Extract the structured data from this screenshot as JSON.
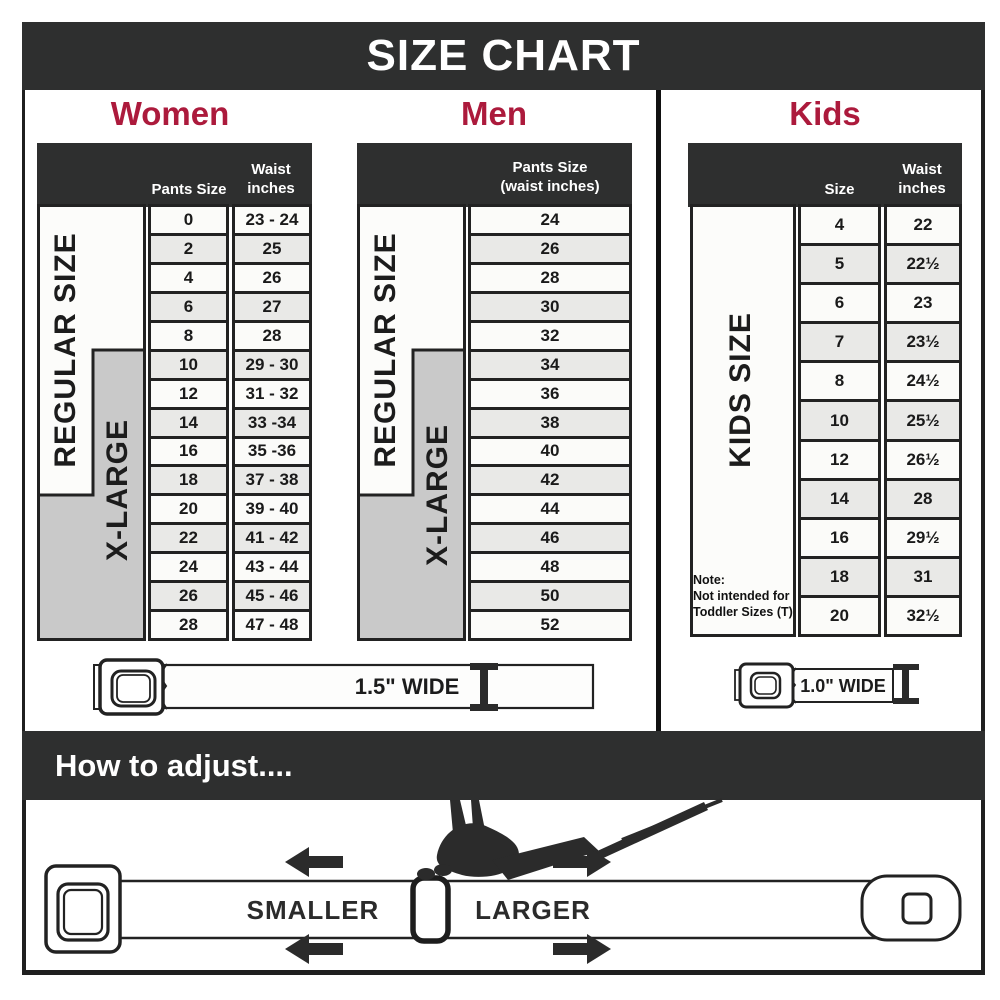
{
  "title": "SIZE CHART",
  "colors": {
    "accent": "#ac1a3c",
    "dark": "#2e2f2f",
    "band_gray": "#c9c9c9"
  },
  "sections": {
    "women": {
      "heading": "Women",
      "col1_header": "Pants Size",
      "col2_header_line1": "Waist",
      "col2_header_line2": "inches",
      "band_regular": "REGULAR SIZE",
      "band_xlarge": "X-LARGE",
      "rows": [
        {
          "size": "0",
          "waist": "23 - 24"
        },
        {
          "size": "2",
          "waist": "25"
        },
        {
          "size": "4",
          "waist": "26"
        },
        {
          "size": "6",
          "waist": "27"
        },
        {
          "size": "8",
          "waist": "28"
        },
        {
          "size": "10",
          "waist": "29 - 30"
        },
        {
          "size": "12",
          "waist": "31 - 32"
        },
        {
          "size": "14",
          "waist": "33 -34"
        },
        {
          "size": "16",
          "waist": "35 -36"
        },
        {
          "size": "18",
          "waist": "37 - 38"
        },
        {
          "size": "20",
          "waist": "39 - 40"
        },
        {
          "size": "22",
          "waist": "41 - 42"
        },
        {
          "size": "24",
          "waist": "43 - 44"
        },
        {
          "size": "26",
          "waist": "45 - 46"
        },
        {
          "size": "28",
          "waist": "47 - 48"
        }
      ]
    },
    "men": {
      "heading": "Men",
      "col_header_line1": "Pants Size",
      "col_header_line2": "(waist inches)",
      "band_regular": "REGULAR SIZE",
      "band_xlarge": "X-LARGE",
      "rows": [
        "24",
        "26",
        "28",
        "30",
        "32",
        "34",
        "36",
        "38",
        "40",
        "42",
        "44",
        "46",
        "48",
        "50",
        "52"
      ]
    },
    "kids": {
      "heading": "Kids",
      "col1_header": "Size",
      "col2_header_line1": "Waist",
      "col2_header_line2": "inches",
      "band": "KIDS SIZE",
      "note_line1": "Note:",
      "note_line2": "Not intended for",
      "note_line3": "Toddler Sizes (T)",
      "rows": [
        {
          "size": "4",
          "waist": "22"
        },
        {
          "size": "5",
          "waist": "22½"
        },
        {
          "size": "6",
          "waist": "23"
        },
        {
          "size": "7",
          "waist": "23½"
        },
        {
          "size": "8",
          "waist": "24½"
        },
        {
          "size": "10",
          "waist": "25½"
        },
        {
          "size": "12",
          "waist": "26½"
        },
        {
          "size": "14",
          "waist": "28"
        },
        {
          "size": "16",
          "waist": "29½"
        },
        {
          "size": "18",
          "waist": "31"
        },
        {
          "size": "20",
          "waist": "32½"
        }
      ]
    }
  },
  "belts": {
    "adult_width_label": "1.5\" WIDE",
    "kids_width_label": "1.0\" WIDE"
  },
  "adjust": {
    "heading": "How to adjust....",
    "smaller_label": "SMALLER",
    "larger_label": "LARGER"
  }
}
